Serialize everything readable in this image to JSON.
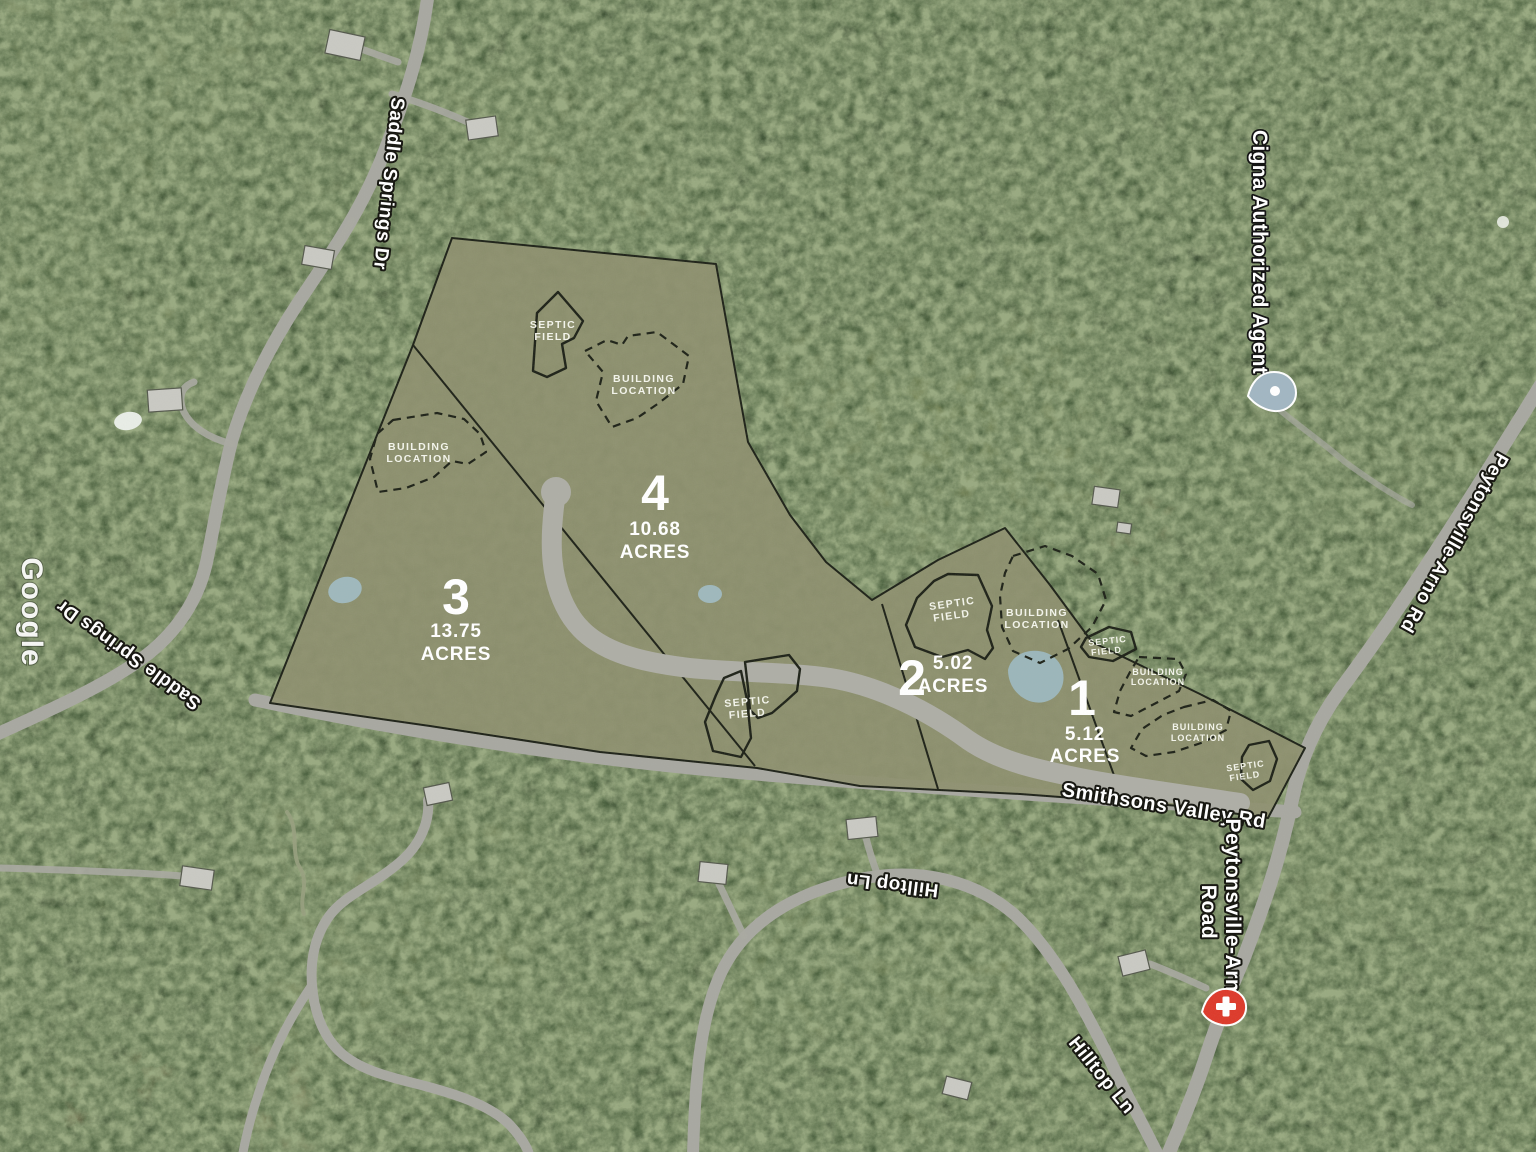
{
  "map": {
    "watermark": "Google",
    "poi_cigna": "Cigna Authorized Agent",
    "roads": {
      "saddle_springs": "Saddle Springs Dr",
      "smithsons_valley": "Smithsons Valley Rd",
      "peytonsville_rd": "Peytonsville-Arno Rd",
      "peytonsville_road_l1": "Peytonsville-Arno",
      "peytonsville_road_l2": "Road",
      "hilltop": "Hilltop Ln"
    },
    "lots": [
      {
        "number": "4",
        "acres": "10.68",
        "unit": "ACRES"
      },
      {
        "number": "3",
        "acres": "13.75",
        "unit": "ACRES"
      },
      {
        "number": "2",
        "acres": "5.02",
        "unit": "ACRES"
      },
      {
        "number": "1",
        "acres": "5.12",
        "unit": "ACRES"
      }
    ],
    "labels": {
      "septic1": "SEPTIC",
      "septic2": "FIELD",
      "building1": "BUILDING",
      "building2": "LOCATION"
    },
    "colors": {
      "overlay": "#8e9070",
      "outline": "#20241a",
      "pond": "#9fb8bc",
      "road": "#a8a8a1",
      "cigna_pin": "#a2b6c2",
      "hospital_pin": "#dd3b2c"
    }
  }
}
